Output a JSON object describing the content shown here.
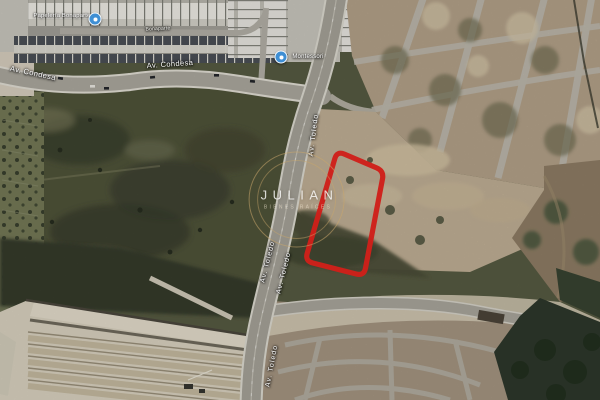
{
  "map": {
    "kind": "satellite-view",
    "description": "Aerial satellite map with red-outlined land parcel beside Av. Toledo"
  },
  "watermark": {
    "title": "JULIAN",
    "subtitle": "BIENES RAÍCES"
  },
  "highlight": {
    "name": "parcel-outline",
    "color": "#e8231d"
  },
  "pois": [
    {
      "label": "Papelería Bonaparte",
      "icon": "blue-circle-poi"
    },
    {
      "label": "Montessori",
      "icon": "blue-circle-poi"
    }
  ],
  "streets": [
    {
      "text": "Av. Condesa"
    },
    {
      "text": "Av. Condesa"
    },
    {
      "text": "Bonaparte"
    },
    {
      "text": "Av. Toledo"
    },
    {
      "text": "Av. Toledo"
    },
    {
      "text": "Av. Toledo"
    },
    {
      "text": "Av. Toledo"
    }
  ],
  "colors": {
    "poi_marker_blue": "#3f8fd4",
    "watermark_gold": "#c9a66b",
    "highlight_red": "#e8231d"
  }
}
